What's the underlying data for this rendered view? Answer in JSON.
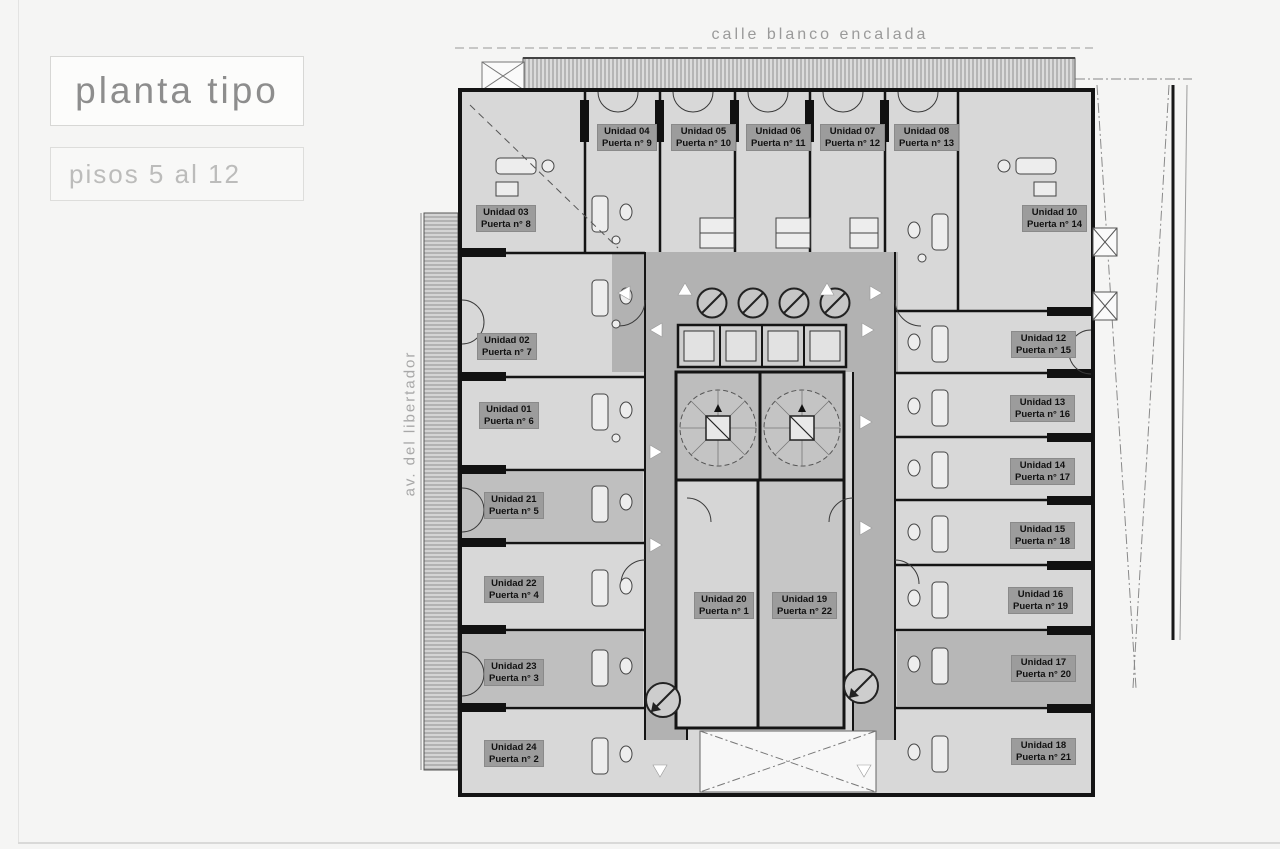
{
  "page": {
    "title": "planta tipo",
    "subtitle": "pisos 5 al 12",
    "street_top": "calle blanco encalada",
    "street_left": "av. del libertador"
  },
  "colors": {
    "page_bg": "#f5f5f4",
    "room_fill": "#d8d8d8",
    "room_dark_fill": "#bfbfbf",
    "corridor_fill": "#b2b2b2",
    "wall": "#141414",
    "label_bg": "#9c9c9c",
    "title_gray": "#8d8d8d",
    "subtitle_gray": "#bcbcbb"
  },
  "units": [
    {
      "name": "Unidad 04",
      "door": "Puerta n° 9",
      "x": 597,
      "y": 124
    },
    {
      "name": "Unidad 05",
      "door": "Puerta n° 10",
      "x": 671,
      "y": 124
    },
    {
      "name": "Unidad 06",
      "door": "Puerta n° 11",
      "x": 746,
      "y": 124
    },
    {
      "name": "Unidad 07",
      "door": "Puerta n° 12",
      "x": 820,
      "y": 124
    },
    {
      "name": "Unidad 08",
      "door": "Puerta n° 13",
      "x": 894,
      "y": 124
    },
    {
      "name": "Unidad 03",
      "door": "Puerta n° 8",
      "x": 476,
      "y": 205
    },
    {
      "name": "Unidad 10",
      "door": "Puerta n° 14",
      "x": 1022,
      "y": 205
    },
    {
      "name": "Unidad 02",
      "door": "Puerta n° 7",
      "x": 477,
      "y": 333
    },
    {
      "name": "Unidad 12",
      "door": "Puerta n° 15",
      "x": 1011,
      "y": 331
    },
    {
      "name": "Unidad 01",
      "door": "Puerta n° 6",
      "x": 479,
      "y": 402
    },
    {
      "name": "Unidad 13",
      "door": "Puerta n° 16",
      "x": 1010,
      "y": 395
    },
    {
      "name": "Unidad 21",
      "door": "Puerta n° 5",
      "x": 484,
      "y": 492
    },
    {
      "name": "Unidad 14",
      "door": "Puerta n° 17",
      "x": 1010,
      "y": 458
    },
    {
      "name": "Unidad 22",
      "door": "Puerta n° 4",
      "x": 484,
      "y": 576
    },
    {
      "name": "Unidad 15",
      "door": "Puerta n° 18",
      "x": 1010,
      "y": 522
    },
    {
      "name": "Unidad 23",
      "door": "Puerta n° 3",
      "x": 484,
      "y": 659
    },
    {
      "name": "Unidad 16",
      "door": "Puerta n° 19",
      "x": 1008,
      "y": 587
    },
    {
      "name": "Unidad 20",
      "door": "Puerta n° 1",
      "x": 694,
      "y": 592
    },
    {
      "name": "Unidad 19",
      "door": "Puerta n° 22",
      "x": 772,
      "y": 592
    },
    {
      "name": "Unidad 17",
      "door": "Puerta n° 20",
      "x": 1011,
      "y": 655
    },
    {
      "name": "Unidad 18",
      "door": "Puerta n° 21",
      "x": 1011,
      "y": 738
    },
    {
      "name": "Unidad 24",
      "door": "Puerta n° 2",
      "x": 484,
      "y": 740
    }
  ]
}
